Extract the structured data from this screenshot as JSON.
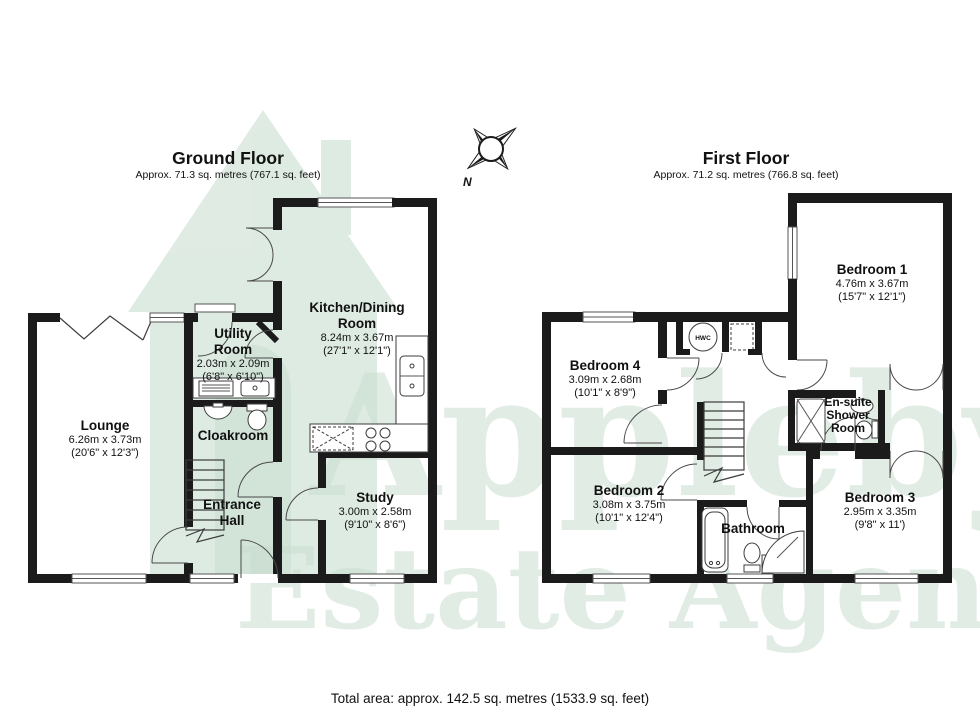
{
  "floors": [
    {
      "title": "Ground Floor",
      "subtitle": "Approx. 71.3 sq. metres (767.1 sq. feet)",
      "rooms": [
        {
          "name": "Lounge",
          "metric": "6.26m x 3.73m",
          "imperial": "(20'6\" x 12'3\")"
        },
        {
          "name": "Utility Room",
          "metric": "2.03m x 2.09m",
          "imperial": "(6'8\" x 6'10\")"
        },
        {
          "name": "Cloakroom"
        },
        {
          "name": "Entrance Hall"
        },
        {
          "name": "Kitchen/Dining Room",
          "metric": "8.24m x 3.67m",
          "imperial": "(27'1\" x 12'1\")"
        },
        {
          "name": "Study",
          "metric": "3.00m x 2.58m",
          "imperial": "(9'10\" x 8'6\")"
        }
      ]
    },
    {
      "title": "First Floor",
      "subtitle": "Approx. 71.2 sq. metres (766.8 sq. feet)",
      "rooms": [
        {
          "name": "Bedroom 1",
          "metric": "4.76m x 3.67m",
          "imperial": "(15'7\" x 12'1\")"
        },
        {
          "name": "Bedroom 4",
          "metric": "3.09m x 2.68m",
          "imperial": "(10'1\" x 8'9\")"
        },
        {
          "name": "Bedroom 2",
          "metric": "3.08m x 3.75m",
          "imperial": "(10'1\" x 12'4\")"
        },
        {
          "name": "Bedroom 3",
          "metric": "2.95m x 3.35m",
          "imperial": "(9'8\" x 11')"
        },
        {
          "name": "En-suite Shower Room"
        },
        {
          "name": "Bathroom"
        }
      ],
      "cupboard_label": "HWC"
    }
  ],
  "compass": {
    "north_label": "N"
  },
  "watermark": {
    "brand_line1": "Appleby's",
    "brand_line2": "Estate Agents"
  },
  "footer": {
    "total_area": "Total area: approx. 142.5 sq. metres (1533.9 sq. feet)"
  },
  "colors": {
    "wall": "#1b1b1b",
    "watermark_green": "#d9e8de",
    "watermark_text": "#c9ddd0",
    "background": "#ffffff"
  }
}
